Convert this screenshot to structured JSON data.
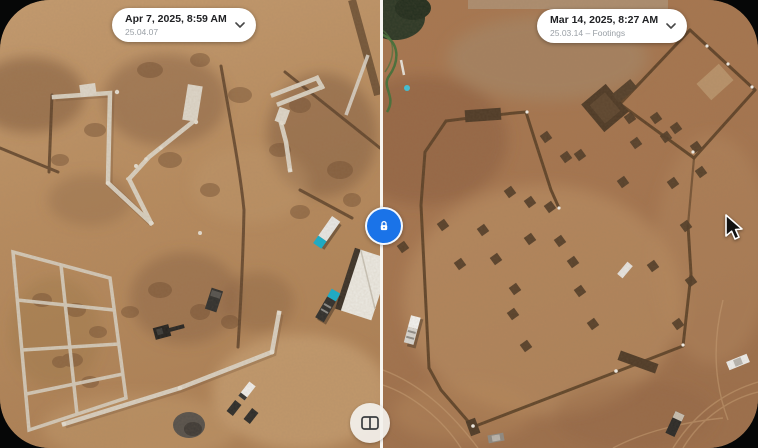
{
  "window": {
    "background_color": "#060707",
    "corner_radius_px": 50
  },
  "compare_view": {
    "left": {
      "date": "Apr 7, 2025, 8:59 AM",
      "version": "25.04.07",
      "description": "aerial photo of construction site with concrete strip footings, trenches, dirt mounds, excavator and trucks"
    },
    "right": {
      "date": "Mar 14, 2025, 8:27 AM",
      "version": "25.03.14 – Footings",
      "description": "aerial photo of earlier footings stage with excavated square pads, perimeter trenches and pickup trucks"
    },
    "lock": {
      "icon": "lock-icon",
      "background_color": "#1a73e8"
    },
    "view_toggle": {
      "icon": "split-view-icon"
    }
  },
  "cursor": {
    "x": 724,
    "y": 213
  }
}
